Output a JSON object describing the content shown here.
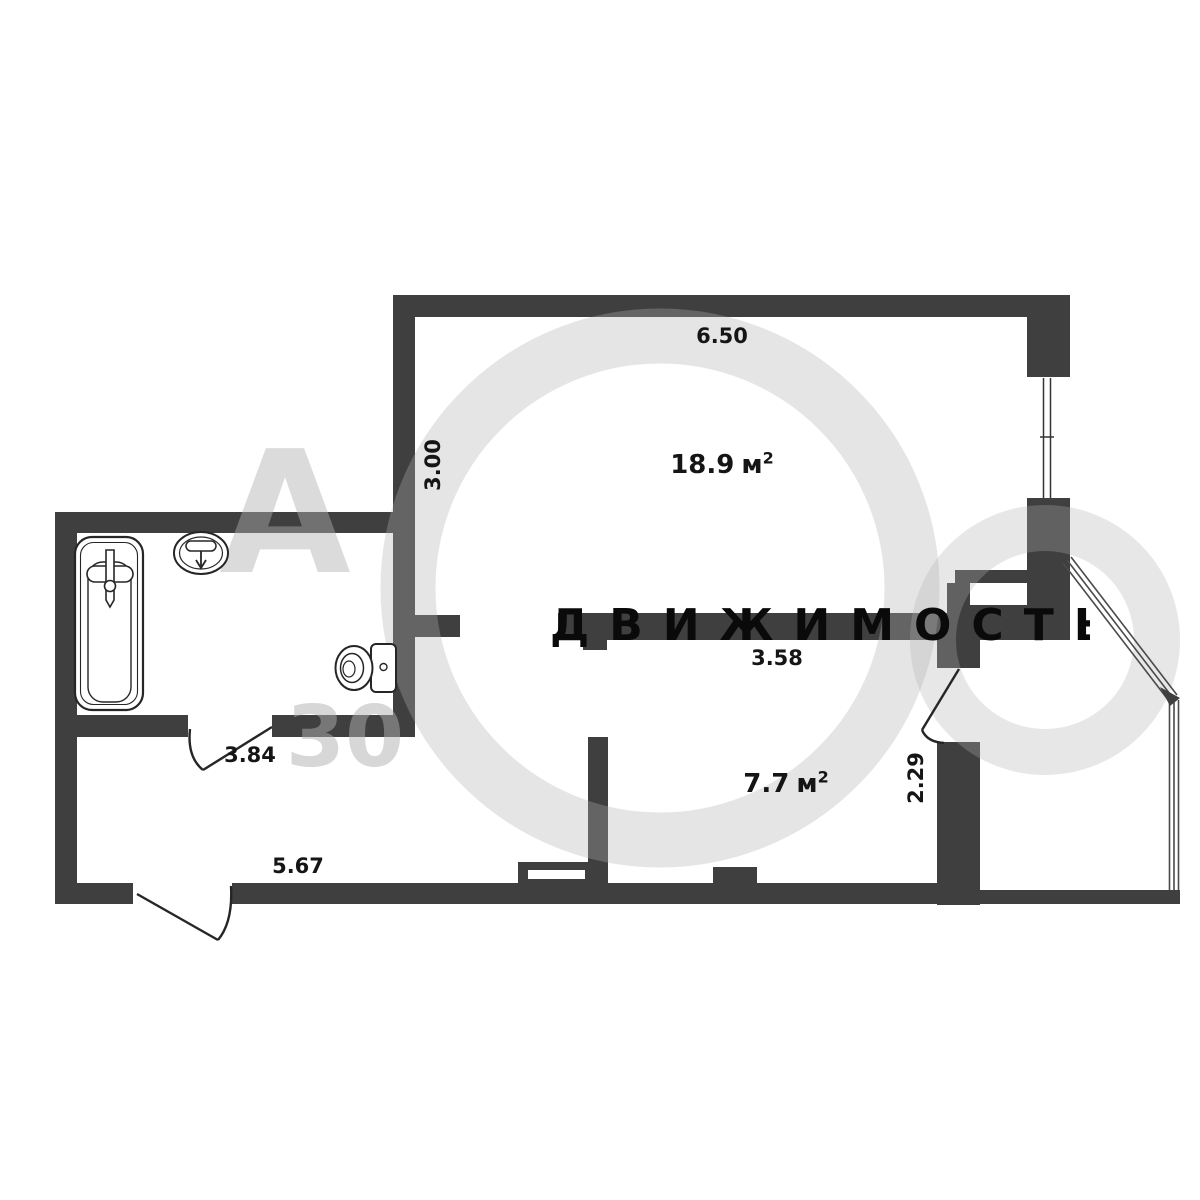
{
  "plan": {
    "rooms": [
      {
        "name": "main-room",
        "area_value": "18.9",
        "unit_base": "м",
        "unit_sup": "2"
      },
      {
        "name": "hall-room",
        "area_value": "7.7",
        "unit_base": "м",
        "unit_sup": "2"
      }
    ],
    "dimensions": {
      "top_width": "6.50",
      "left_height": "3.00",
      "inner_wall": "3.58",
      "bath_door": "3.84",
      "hall_width": "5.67",
      "right_door": "2.29"
    },
    "watermark": {
      "band_text": "ДВИЖИМОСТЬ",
      "letter": "А",
      "number": "30"
    },
    "fixtures": [
      "bathtub-icon",
      "sink-icon",
      "toilet-icon"
    ],
    "colors": {
      "wall": "#3f3f3f",
      "ink": "#151515",
      "watermark_band": "#0a0a0a"
    }
  }
}
